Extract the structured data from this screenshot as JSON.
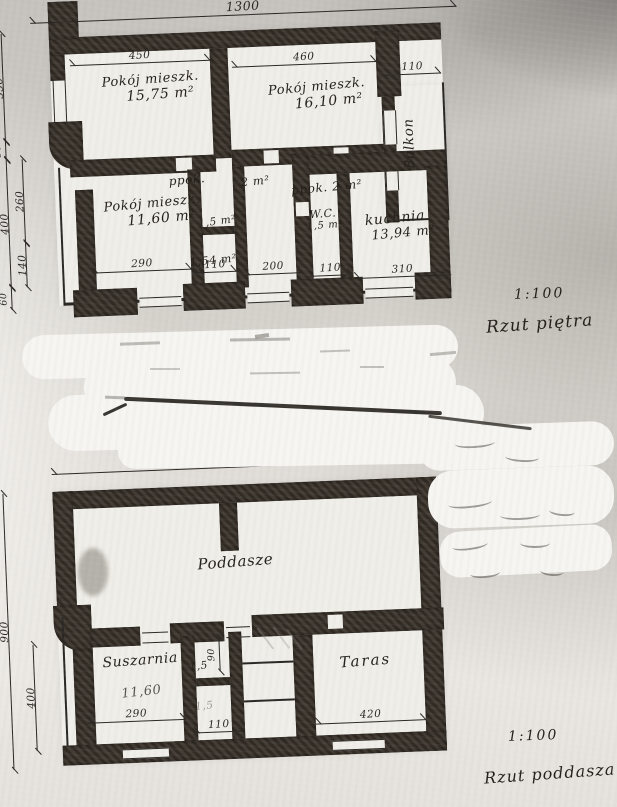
{
  "colors": {
    "ink": "#2a2724",
    "wall": "#3a332b",
    "room": "#f0eee8",
    "paper": "#d2cfc9"
  },
  "floor_plan": {
    "scale": "1:100",
    "caption": "Rzut piętra",
    "rooms": {
      "room1_name": "Pokój mieszk.",
      "room1_area": "15,75 m²",
      "room2_name": "Pokój mieszk.",
      "room2_area": "16,10 m²",
      "balcony": "Balkon",
      "room3_name": "Pokój mieszk.",
      "room3_area": "11,60 m²",
      "ppok1_name": "ppok.",
      "ppok1_area": "2 m²",
      "ppok2_name": "ppok.",
      "ppok2_area": "2 m²",
      "small1_area": "1,5 m²",
      "small2_area": "1,54 m²",
      "wc_name": "W.C.",
      "wc_area": "1,5 m²",
      "kitchen_name": "kuchnia",
      "kitchen_area": "13,94 m²"
    },
    "dims": {
      "total": "1300",
      "room1_w": "450",
      "room2_w": "460",
      "balcony_w": "110",
      "left_350": "350",
      "left_50": "50",
      "left_400": "400",
      "left_60": "60",
      "left_260": "260",
      "left_140": "140",
      "bottom_290": "290",
      "bottom_110a": "110",
      "bottom_200": "200",
      "bottom_110b": "110",
      "bottom_310": "310"
    }
  },
  "attic_plan": {
    "scale": "1:100",
    "caption": "Rzut poddasza",
    "rooms": {
      "attic": "Poddasze",
      "dryer_name": "Suszarnia",
      "dryer_area": "11,60",
      "small1_area": "1,5",
      "small2_area": "1,5",
      "terrace": "Taras"
    },
    "dims": {
      "total": "1100",
      "left_900": "900",
      "left_400": "400",
      "mid_90": "90",
      "bottom_290": "290",
      "bottom_110": "110",
      "bottom_420": "420"
    }
  }
}
